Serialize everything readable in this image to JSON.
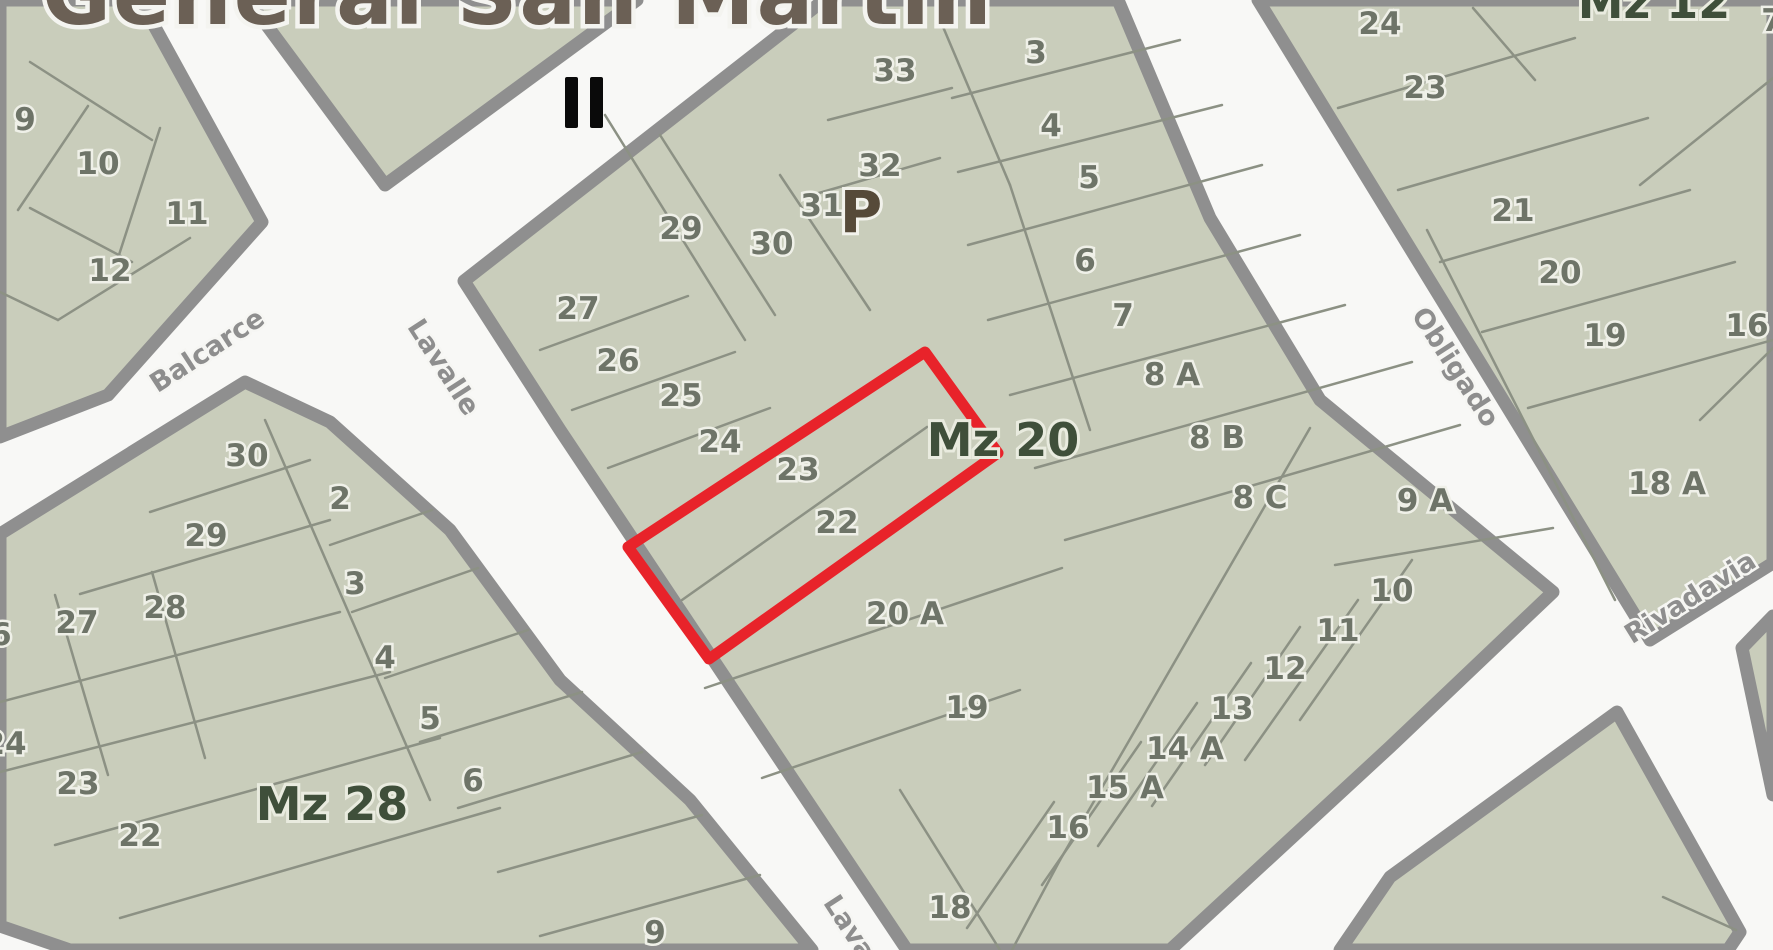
{
  "title": "General San Martín",
  "route_marker": "II",
  "colors": {
    "street_bg": "#f8f8f6",
    "block_fill": "#c9cdbb",
    "block_casing": "#8f8f8f",
    "lot_line": "#8c9184",
    "lot_number": "#6e7468",
    "mz_label": "#3f4f3a",
    "p_label": "#564a39",
    "title": "#6b6055",
    "street_label": "#8e8e8e",
    "highlight_red": "#e8232a",
    "marker_black": "#0a0a0a"
  },
  "streets": [
    {
      "name": "Balcarce",
      "x": 212,
      "y": 358,
      "angle": -33
    },
    {
      "name": "Lavalle",
      "x": 436,
      "y": 372,
      "angle": 57
    },
    {
      "name": "Obligado",
      "x": 1448,
      "y": 372,
      "angle": 57
    },
    {
      "name": "Rivadavia",
      "x": 1695,
      "y": 605,
      "angle": -32
    },
    {
      "name": "Lavalle",
      "x": 852,
      "y": 948,
      "angle": 57
    }
  ],
  "marker": {
    "label": "II",
    "x": 565,
    "y": 77
  },
  "red_parcel": {
    "points": "925,352 998,453 709,659 628,547",
    "covers_lots": "22, 23",
    "block": "Mz 20"
  },
  "blocks": [
    {
      "name": "block-northwest",
      "label": null,
      "outline": [
        [
          0,
          0
        ],
        [
          140,
          0
        ],
        [
          262,
          222
        ],
        [
          108,
          395
        ],
        [
          0,
          437
        ]
      ],
      "lines": [
        [
          30,
          62,
          152,
          140
        ],
        [
          88,
          106,
          18,
          210
        ],
        [
          30,
          208,
          132,
          262
        ],
        [
          160,
          128,
          118,
          258
        ],
        [
          58,
          320,
          190,
          238
        ],
        [
          0,
          292,
          58,
          320
        ]
      ],
      "lots": [
        {
          "label": "9",
          "x": 25,
          "y": 119
        },
        {
          "label": "10",
          "x": 98,
          "y": 163
        },
        {
          "label": "11",
          "x": 187,
          "y": 213
        },
        {
          "label": "12",
          "x": 110,
          "y": 270
        }
      ]
    },
    {
      "name": "block-top-sliver",
      "label": null,
      "outline": [
        [
          248,
          0
        ],
        [
          637,
          0
        ],
        [
          385,
          185
        ]
      ],
      "lines": [],
      "lots": []
    },
    {
      "name": "block-mz28",
      "label": {
        "text": "Mz 28",
        "x": 332,
        "y": 820
      },
      "outline": [
        [
          245,
          382
        ],
        [
          330,
          422
        ],
        [
          450,
          530
        ],
        [
          560,
          680
        ],
        [
          690,
          800
        ],
        [
          812,
          950
        ],
        [
          70,
          950
        ],
        [
          0,
          926
        ],
        [
          0,
          534
        ]
      ],
      "lines": [
        [
          150,
          512,
          310,
          460
        ],
        [
          80,
          594,
          330,
          520
        ],
        [
          152,
          572,
          205,
          758
        ],
        [
          55,
          595,
          108,
          775
        ],
        [
          0,
          702,
          340,
          612
        ],
        [
          0,
          772,
          390,
          672
        ],
        [
          55,
          845,
          440,
          738
        ],
        [
          120,
          918,
          500,
          808
        ],
        [
          265,
          420,
          430,
          800
        ],
        [
          330,
          545,
          432,
          510
        ],
        [
          352,
          612,
          478,
          568
        ],
        [
          385,
          678,
          528,
          630
        ],
        [
          420,
          742,
          582,
          692
        ],
        [
          458,
          808,
          642,
          752
        ],
        [
          498,
          872,
          702,
          815
        ],
        [
          540,
          936,
          760,
          875
        ]
      ],
      "lots": [
        {
          "label": "30",
          "x": 247,
          "y": 455
        },
        {
          "label": "2",
          "x": 340,
          "y": 498
        },
        {
          "label": "29",
          "x": 206,
          "y": 535
        },
        {
          "label": "3",
          "x": 355,
          "y": 583
        },
        {
          "label": "28",
          "x": 165,
          "y": 607
        },
        {
          "label": "27",
          "x": 77,
          "y": 622
        },
        {
          "label": "26",
          "x": -10,
          "y": 634
        },
        {
          "label": "4",
          "x": 385,
          "y": 657
        },
        {
          "label": "5",
          "x": 430,
          "y": 718
        },
        {
          "label": "24",
          "x": 5,
          "y": 743
        },
        {
          "label": "6",
          "x": 473,
          "y": 780
        },
        {
          "label": "23",
          "x": 78,
          "y": 783
        },
        {
          "label": "22",
          "x": 140,
          "y": 835
        },
        {
          "label": "9",
          "x": 655,
          "y": 932
        }
      ]
    },
    {
      "name": "block-mz20",
      "label": {
        "text": "Mz 20",
        "x": 1003,
        "y": 456
      },
      "outline": [
        [
          824,
          0
        ],
        [
          1118,
          0
        ],
        [
          1210,
          218
        ],
        [
          1320,
          400
        ],
        [
          1553,
          592
        ],
        [
          1390,
          747
        ],
        [
          1170,
          950
        ],
        [
          907,
          950
        ],
        [
          800,
          790
        ],
        [
          710,
          655
        ],
        [
          640,
          550
        ],
        [
          560,
          430
        ],
        [
          464,
          281
        ]
      ],
      "lines": [
        [
          605,
          115,
          745,
          340
        ],
        [
          660,
          135,
          775,
          315
        ],
        [
          780,
          175,
          870,
          310
        ],
        [
          938,
          15,
          1010,
          185
        ],
        [
          1010,
          185,
          1090,
          430
        ],
        [
          828,
          120,
          952,
          88
        ],
        [
          812,
          195,
          940,
          158
        ],
        [
          540,
          350,
          688,
          296
        ],
        [
          572,
          410,
          735,
          352
        ],
        [
          608,
          468,
          770,
          408
        ],
        [
          682,
          600,
          927,
          427
        ],
        [
          705,
          688,
          1062,
          568
        ],
        [
          762,
          778,
          1020,
          690
        ],
        [
          952,
          98,
          1180,
          40
        ],
        [
          958,
          172,
          1222,
          105
        ],
        [
          968,
          245,
          1262,
          165
        ],
        [
          988,
          320,
          1300,
          235
        ],
        [
          1010,
          395,
          1345,
          305
        ],
        [
          1035,
          468,
          1412,
          362
        ],
        [
          1065,
          540,
          1460,
          425
        ],
        [
          1310,
          428,
          1060,
          860
        ],
        [
          1060,
          860,
          1012,
          950
        ],
        [
          1335,
          565,
          1553,
          528
        ],
        [
          1412,
          560,
          1300,
          720
        ],
        [
          1358,
          600,
          1245,
          760
        ],
        [
          1300,
          627,
          1205,
          765
        ],
        [
          1251,
          663,
          1152,
          806
        ],
        [
          1197,
          703,
          1098,
          846
        ],
        [
          1141,
          742,
          1042,
          885
        ],
        [
          1054,
          802,
          967,
          928
        ],
        [
          900,
          790,
          1000,
          950
        ]
      ],
      "lots": [
        {
          "label": "33",
          "x": 895,
          "y": 70
        },
        {
          "label": "3",
          "x": 1036,
          "y": 52
        },
        {
          "label": "4",
          "x": 1051,
          "y": 125
        },
        {
          "label": "32",
          "x": 880,
          "y": 165
        },
        {
          "label": "5",
          "x": 1089,
          "y": 177
        },
        {
          "label": "31",
          "x": 822,
          "y": 205
        },
        {
          "label": "29",
          "x": 681,
          "y": 228
        },
        {
          "label": "30",
          "x": 772,
          "y": 243
        },
        {
          "label": "6",
          "x": 1085,
          "y": 260
        },
        {
          "label": "27",
          "x": 578,
          "y": 308
        },
        {
          "label": "7",
          "x": 1123,
          "y": 315
        },
        {
          "label": "26",
          "x": 618,
          "y": 360
        },
        {
          "label": "8 A",
          "x": 1172,
          "y": 374
        },
        {
          "label": "25",
          "x": 681,
          "y": 395
        },
        {
          "label": "24",
          "x": 720,
          "y": 441
        },
        {
          "label": "8 B",
          "x": 1217,
          "y": 437
        },
        {
          "label": "23",
          "x": 798,
          "y": 469
        },
        {
          "label": "8 C",
          "x": 1260,
          "y": 497
        },
        {
          "label": "9 A",
          "x": 1425,
          "y": 500
        },
        {
          "label": "22",
          "x": 837,
          "y": 522
        },
        {
          "label": "10",
          "x": 1392,
          "y": 590
        },
        {
          "label": "20 A",
          "x": 905,
          "y": 613
        },
        {
          "label": "11",
          "x": 1338,
          "y": 630
        },
        {
          "label": "12",
          "x": 1285,
          "y": 668
        },
        {
          "label": "19",
          "x": 967,
          "y": 707
        },
        {
          "label": "13",
          "x": 1232,
          "y": 708
        },
        {
          "label": "14 A",
          "x": 1185,
          "y": 748
        },
        {
          "label": "15 A",
          "x": 1125,
          "y": 787
        },
        {
          "label": "16",
          "x": 1068,
          "y": 827
        },
        {
          "label": "18",
          "x": 950,
          "y": 907
        }
      ],
      "p_marker": {
        "text": "P",
        "x": 861,
        "y": 232
      }
    },
    {
      "name": "block-mz12",
      "label": {
        "text": "Mz 12",
        "x": 1654,
        "y": 18
      },
      "outline": [
        [
          1258,
          0
        ],
        [
          1773,
          0
        ],
        [
          1773,
          563
        ],
        [
          1650,
          640
        ]
      ],
      "lines": [
        [
          1338,
          108,
          1575,
          38
        ],
        [
          1398,
          190,
          1648,
          118
        ],
        [
          1440,
          262,
          1690,
          190
        ],
        [
          1482,
          332,
          1735,
          262
        ],
        [
          1528,
          408,
          1773,
          340
        ],
        [
          1473,
          8,
          1535,
          80
        ],
        [
          1427,
          230,
          1615,
          600
        ],
        [
          1640,
          185,
          1773,
          78
        ],
        [
          1700,
          420,
          1773,
          348
        ]
      ],
      "lots": [
        {
          "label": "24",
          "x": 1380,
          "y": 23
        },
        {
          "label": "7",
          "x": 1772,
          "y": 20
        },
        {
          "label": "23",
          "x": 1425,
          "y": 87
        },
        {
          "label": "21",
          "x": 1513,
          "y": 210
        },
        {
          "label": "20",
          "x": 1560,
          "y": 272
        },
        {
          "label": "16",
          "x": 1747,
          "y": 325
        },
        {
          "label": "19",
          "x": 1605,
          "y": 335
        },
        {
          "label": "18 A",
          "x": 1667,
          "y": 483
        }
      ]
    },
    {
      "name": "block-southeast",
      "label": null,
      "outline": [
        [
          1617,
          712
        ],
        [
          1740,
          932
        ],
        [
          1728,
          950
        ],
        [
          1340,
          950
        ],
        [
          1390,
          877
        ]
      ],
      "lines": [
        [
          1663,
          897,
          1736,
          930
        ]
      ],
      "lots": []
    },
    {
      "name": "block-east-sliver",
      "label": null,
      "outline": [
        [
          1742,
          648
        ],
        [
          1773,
          616
        ],
        [
          1773,
          795
        ]
      ],
      "lines": [],
      "lots": []
    }
  ]
}
